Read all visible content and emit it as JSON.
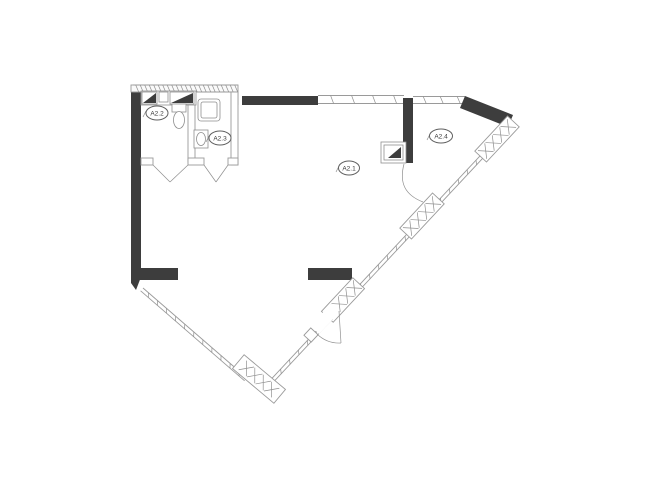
{
  "colors": {
    "wall": "#3d3d3d",
    "line": "#9a9a9a",
    "hatch": "#8f8f8f",
    "fixline": "#8f8f8f",
    "labelstroke": "#5f5f5f",
    "text": "#3a3a3a",
    "bg": "#ffffff"
  },
  "rooms": {
    "a2_1": {
      "label": "A2.1"
    },
    "a2_2": {
      "label": "A2.2"
    },
    "a2_3": {
      "label": "A2.3"
    },
    "a2_4": {
      "label": "A2.4"
    }
  }
}
